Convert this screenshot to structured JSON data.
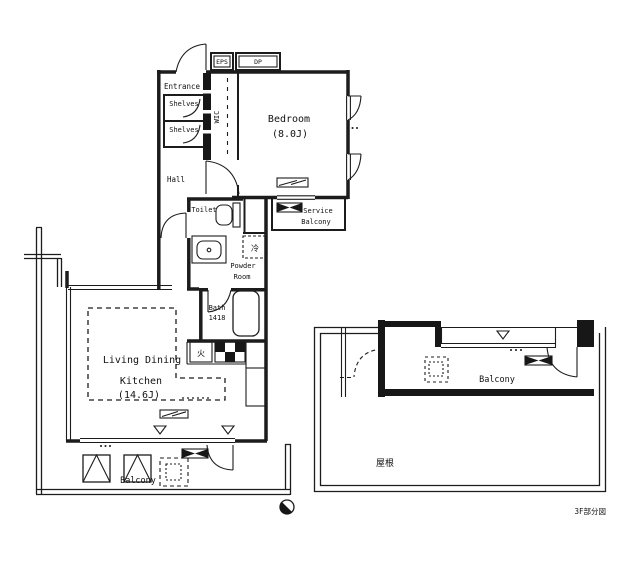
{
  "plan": {
    "labels": {
      "eps": "EPS",
      "dp": "DP",
      "entrance": "Entrance",
      "shelves_upper": "Shelves",
      "shelves_lower": "Shelves",
      "wic": "WIC",
      "bedroom": "Bedroom",
      "bedroom_size": "(8.0J)",
      "hall": "Hall",
      "toilet": "Toilet",
      "service_balcony_1": "Service",
      "service_balcony_2": "Balcony",
      "powder_1": "Powder",
      "powder_2": "Room",
      "refrigerator": "冷",
      "bath": "Bath",
      "bath_size": "1418",
      "stove": "火",
      "ldk_1": "Living Dining",
      "ldk_2": "Kitchen",
      "ldk_size": "(14.6J)",
      "balcony_main": "Balcony",
      "balcony_upper": "Balcony",
      "roof": "屋根"
    },
    "caption": "3F部分図",
    "colors": {
      "line": "#1c1c1c",
      "background": "#ffffff"
    }
  }
}
